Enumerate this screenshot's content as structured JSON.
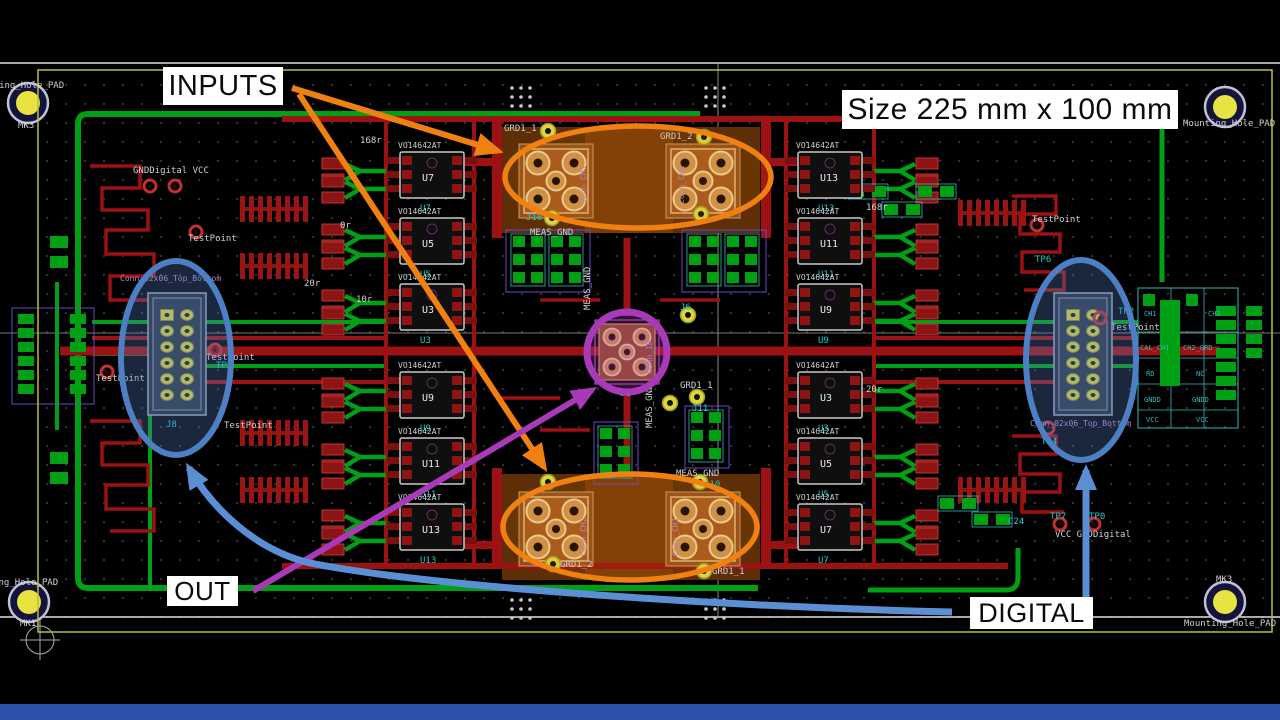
{
  "annotations": {
    "inputs": "INPUTS",
    "size": "Size 225 mm x 100 mm",
    "out": "OUT",
    "digital": "DIGITAL"
  },
  "colors": {
    "annotation_orange": "#f08010",
    "annotation_purple": "#a83ab8",
    "annotation_blue": "#5b8fd4",
    "trace_red": "#9c1111",
    "trace_green": "#00a014",
    "pad_yellow": "#ddd63e",
    "copper_orange": "#a65a20",
    "bottom_strip_blue": "#2d52aa"
  },
  "board": {
    "mount_holes": {
      "tl_ref": "MK3",
      "tl_label": "Mounting_Hole_PAD",
      "tr_label": "Mounting_Hole_PAD",
      "bl_ref": "MK1",
      "bl_label": "Mounting_Hole_PAD",
      "br_ref": "MK3",
      "br_label": "Mounting_Hole_PAD"
    },
    "power_labels": {
      "top_left": "GNDDigital VCC",
      "bottom_right": "VCC GNDDigital"
    },
    "headers": {
      "name": "Conn_02x06_Top_Bottom"
    },
    "center_conn": {
      "name": "Conn_ID",
      "ref": "J1"
    },
    "input_conns": {
      "top_left": "Conn_CH1",
      "top_right": "Conn_CH2",
      "bottom_left": "Conn_CH2",
      "bottom_right": "Conn_CH1",
      "j10": "J10",
      "j11": "J11",
      "j6": "J6",
      "j8": "J8"
    },
    "nets": {
      "grd1_1": "GRD1_1",
      "grd1_2": "GRD1_2",
      "meas_gnd": "MEAS_GND"
    },
    "test_points": {
      "label": "TestPoint",
      "tp0": "TP0",
      "tp2": "TP2",
      "tp4": "TP4",
      "tp5": "TP5",
      "tp6": "TP6",
      "tp7": "TP7",
      "c24": "C24"
    },
    "ics": {
      "part": "VO14642AT",
      "refs": [
        "U7",
        "U5",
        "U3",
        "U9",
        "U11",
        "U13",
        "U13",
        "U11",
        "U9",
        "U3",
        "U5",
        "U7"
      ]
    },
    "values": {
      "v1": "168r",
      "v2": "20r",
      "v3": "0r",
      "v4": "10r"
    },
    "right_block": {
      "r1c1": "CH1",
      "r1c2": "CH2",
      "r2c1": "CAL_CH1",
      "r2c2": "CH2_GRD",
      "r3c1": "RD",
      "r3c2": "NC",
      "r4c1": "GNDD",
      "r4c2": "GNDD",
      "r5c1": "VCC",
      "r5c2": "VCC"
    }
  }
}
